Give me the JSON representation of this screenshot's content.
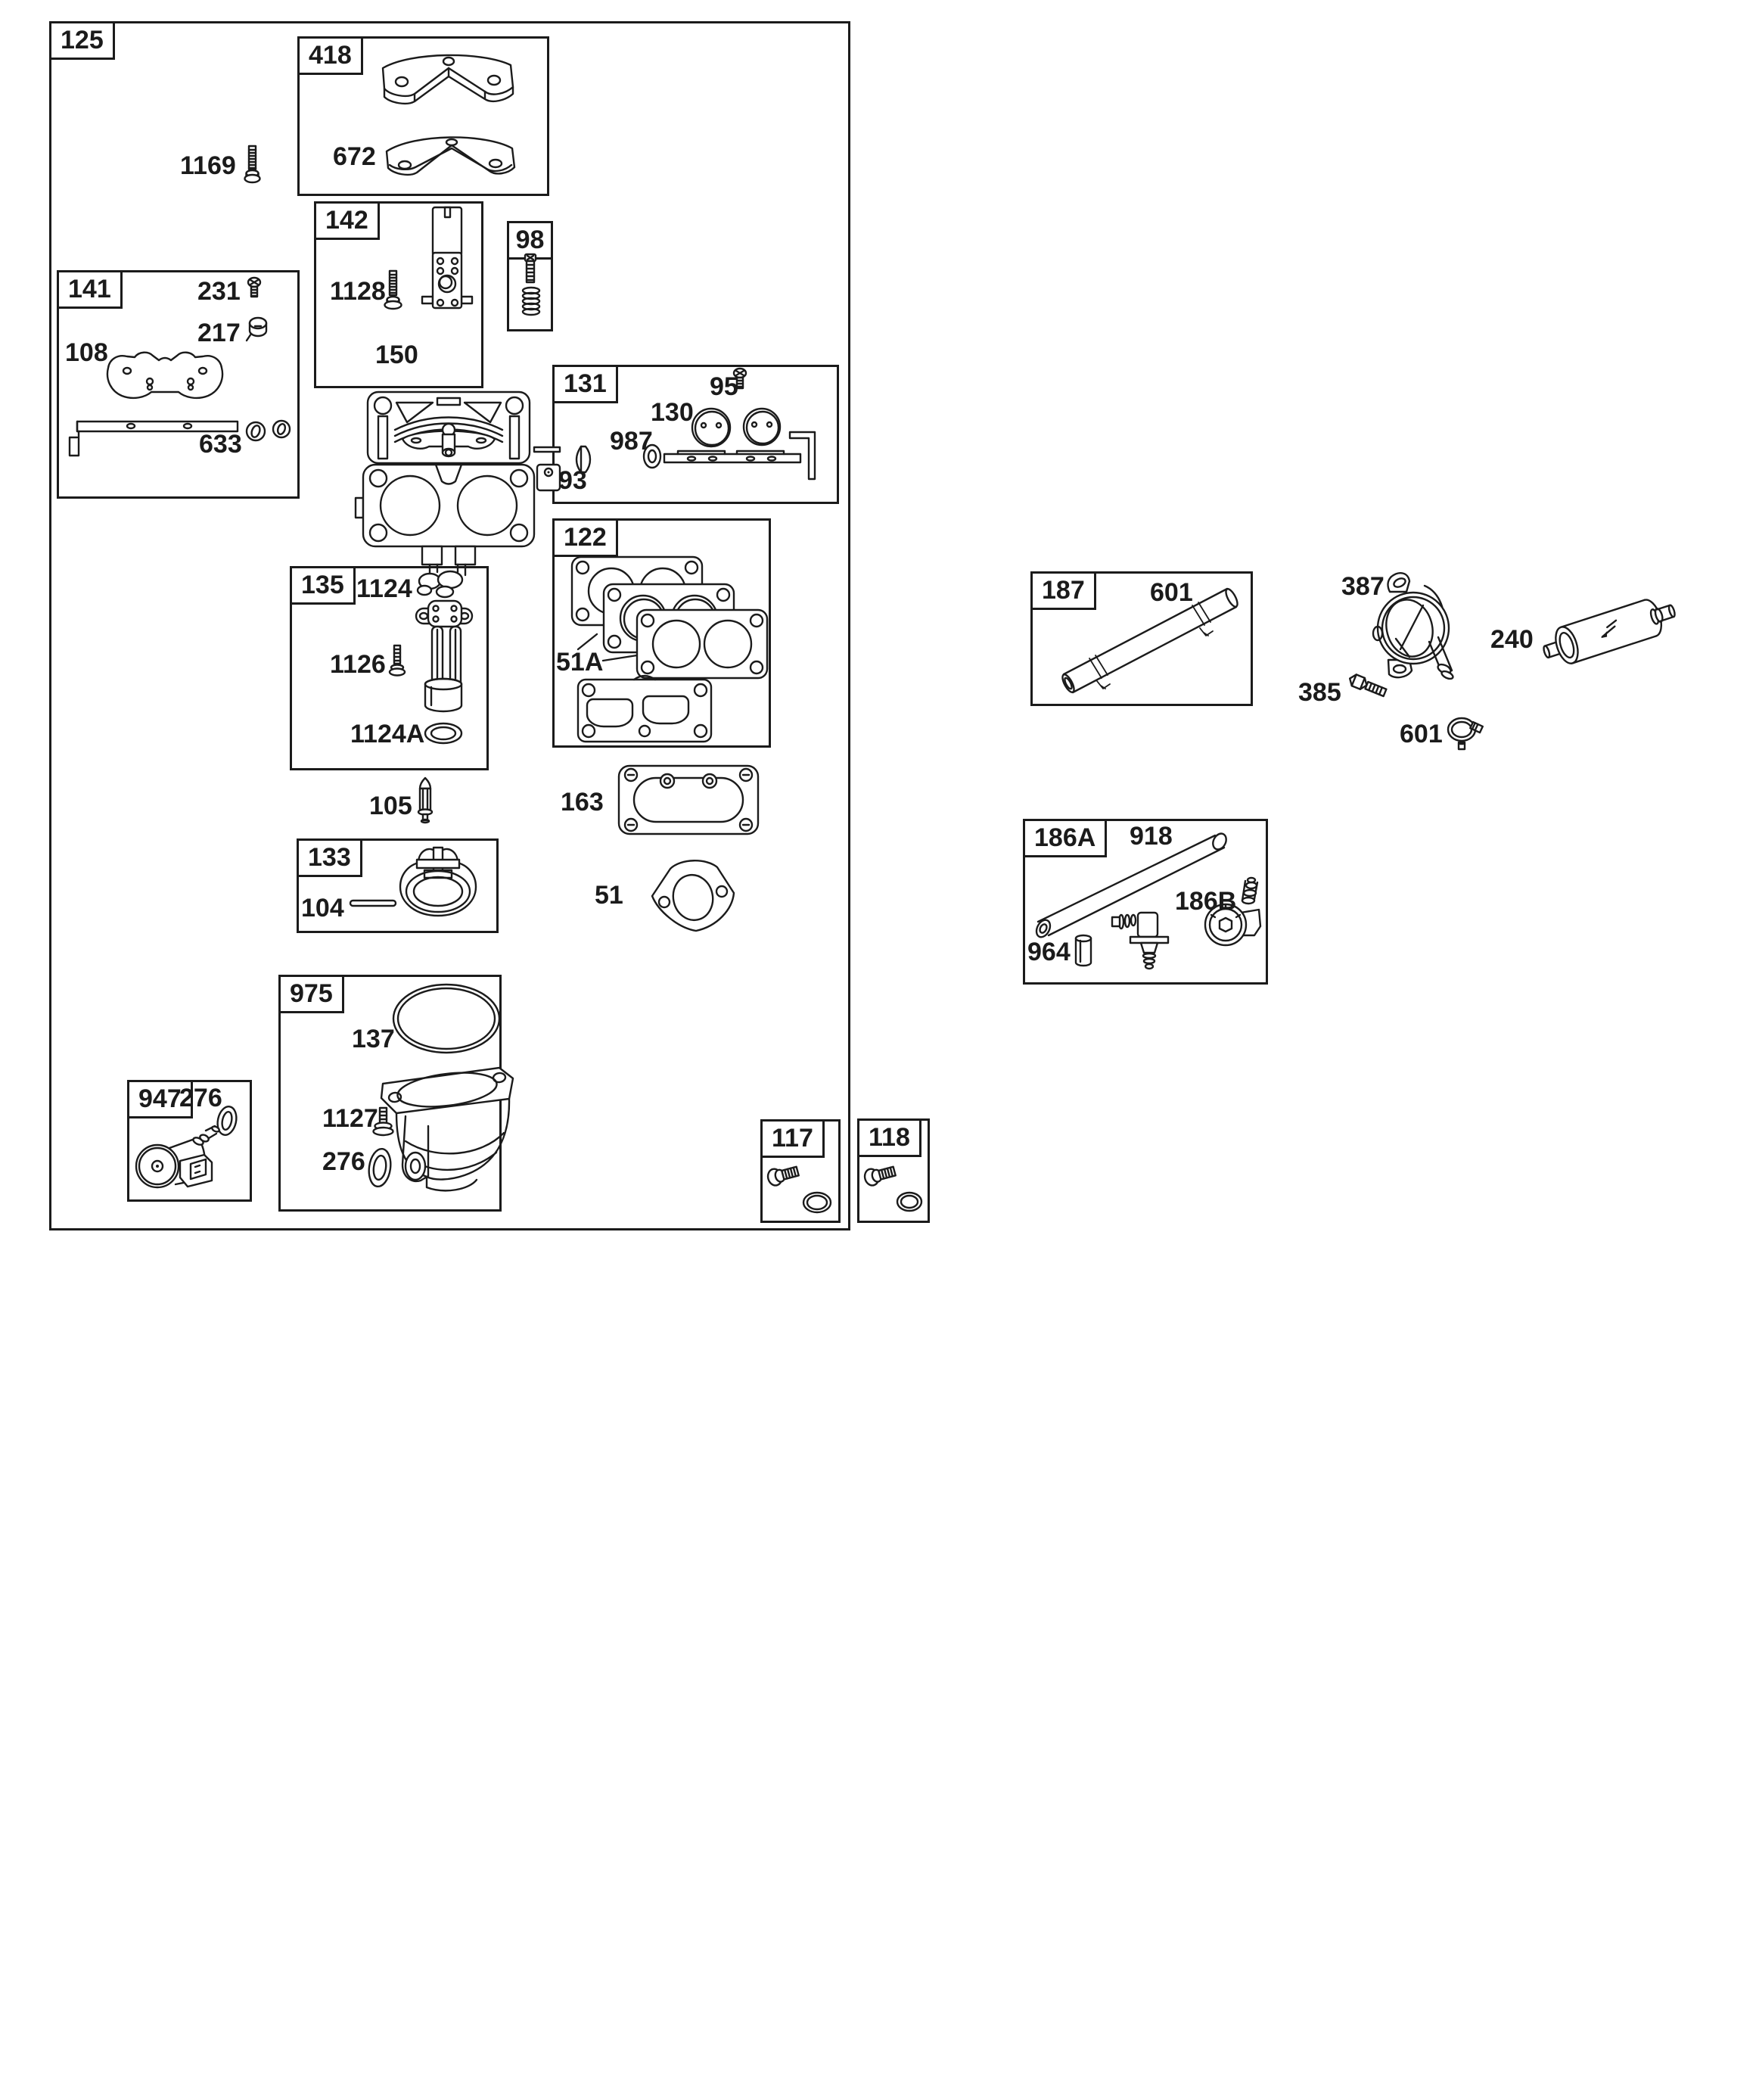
{
  "ink_color": "#1b1b1b",
  "background_color": "#ffffff",
  "groups": {
    "g125": {
      "label": "125",
      "parts": {
        "p1169": "1169",
        "p105": "105",
        "p163": "163",
        "p51": "51"
      }
    },
    "g418": {
      "label": "418",
      "parts": {
        "p672": "672"
      }
    },
    "g142": {
      "label": "142",
      "parts": {
        "p1128": "1128",
        "p150": "150"
      }
    },
    "g98": {
      "label": "98"
    },
    "g141": {
      "label": "141",
      "parts": {
        "p231": "231",
        "p217": "217",
        "p108": "108",
        "p633": "633"
      }
    },
    "g131": {
      "label": "131",
      "parts": {
        "p95": "95",
        "p130": "130",
        "p987": "987",
        "p93": "93"
      }
    },
    "g122": {
      "label": "122",
      "parts": {
        "p51A": "51A"
      }
    },
    "g135": {
      "label": "135",
      "parts": {
        "p1124": "1124",
        "p1126": "1126",
        "p1124A": "1124A"
      }
    },
    "g133": {
      "label": "133",
      "parts": {
        "p104": "104"
      }
    },
    "g975": {
      "label": "975",
      "parts": {
        "p137": "137",
        "p1127": "1127",
        "p276": "276"
      }
    },
    "g947": {
      "label": "947",
      "parts": {
        "p276": "276"
      }
    },
    "g117": {
      "label": "117"
    },
    "g118": {
      "label": "118"
    },
    "g187": {
      "label": "187",
      "parts": {
        "p601": "601"
      }
    },
    "g186A": {
      "label": "186A",
      "parts": {
        "p918": "918",
        "p186B": "186B",
        "p964": "964"
      }
    }
  },
  "fuel_pump_assembly": {
    "parts": {
      "p387": "387",
      "p385": "385",
      "p601": "601",
      "p240": "240"
    }
  }
}
